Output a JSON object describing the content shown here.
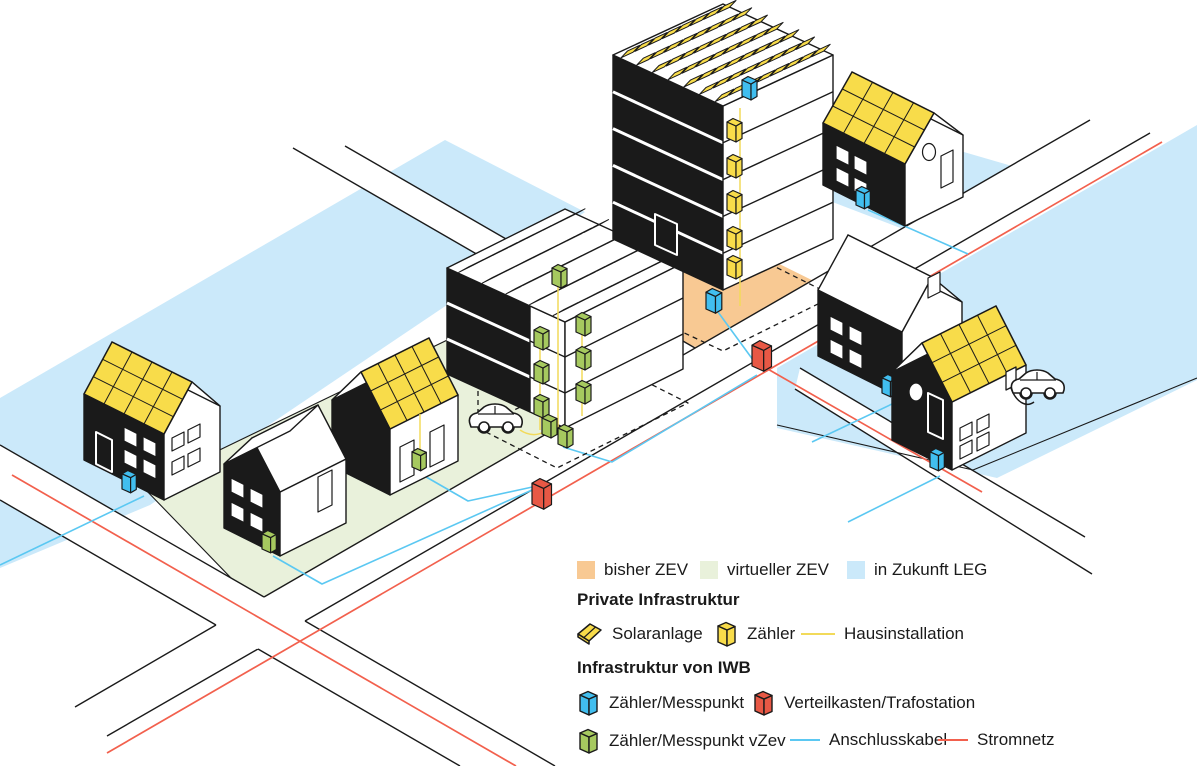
{
  "palette": {
    "ink": "#1a1a1a",
    "solar_yellow": "#F8DC4A",
    "house_installation_yellow": "#F2DA5A",
    "meter_blue": "#41BEEF",
    "cable_blue": "#5BC8F2",
    "box_red": "#E85845",
    "grid_red": "#F2604D",
    "meter_green": "#A6C95F",
    "zone_orange": "#F8C993",
    "zone_green": "#E9F1DB",
    "zone_blue": "#CBE9FA"
  },
  "legend": {
    "zones": [
      {
        "label": "bisher ZEV",
        "color": "#F8C993"
      },
      {
        "label": "virtueller ZEV",
        "color": "#E9F1DB"
      },
      {
        "label": "in Zukunft LEG",
        "color": "#CBE9FA"
      }
    ],
    "private": {
      "heading": "Private Infrastruktur",
      "solar_label": "Solaranlage",
      "meter_label": "Zähler",
      "line_label": "Hausinstallation"
    },
    "iwb": {
      "heading": "Infrastruktur von IWB",
      "meter_label": "Zähler/Messpunkt",
      "box_label": "Verteilkasten/Trafostation",
      "meter_vzev_label": "Zähler/Messpunkt vZev",
      "cable_label": "Anschlusskabel",
      "grid_label": "Stromnetz"
    }
  }
}
